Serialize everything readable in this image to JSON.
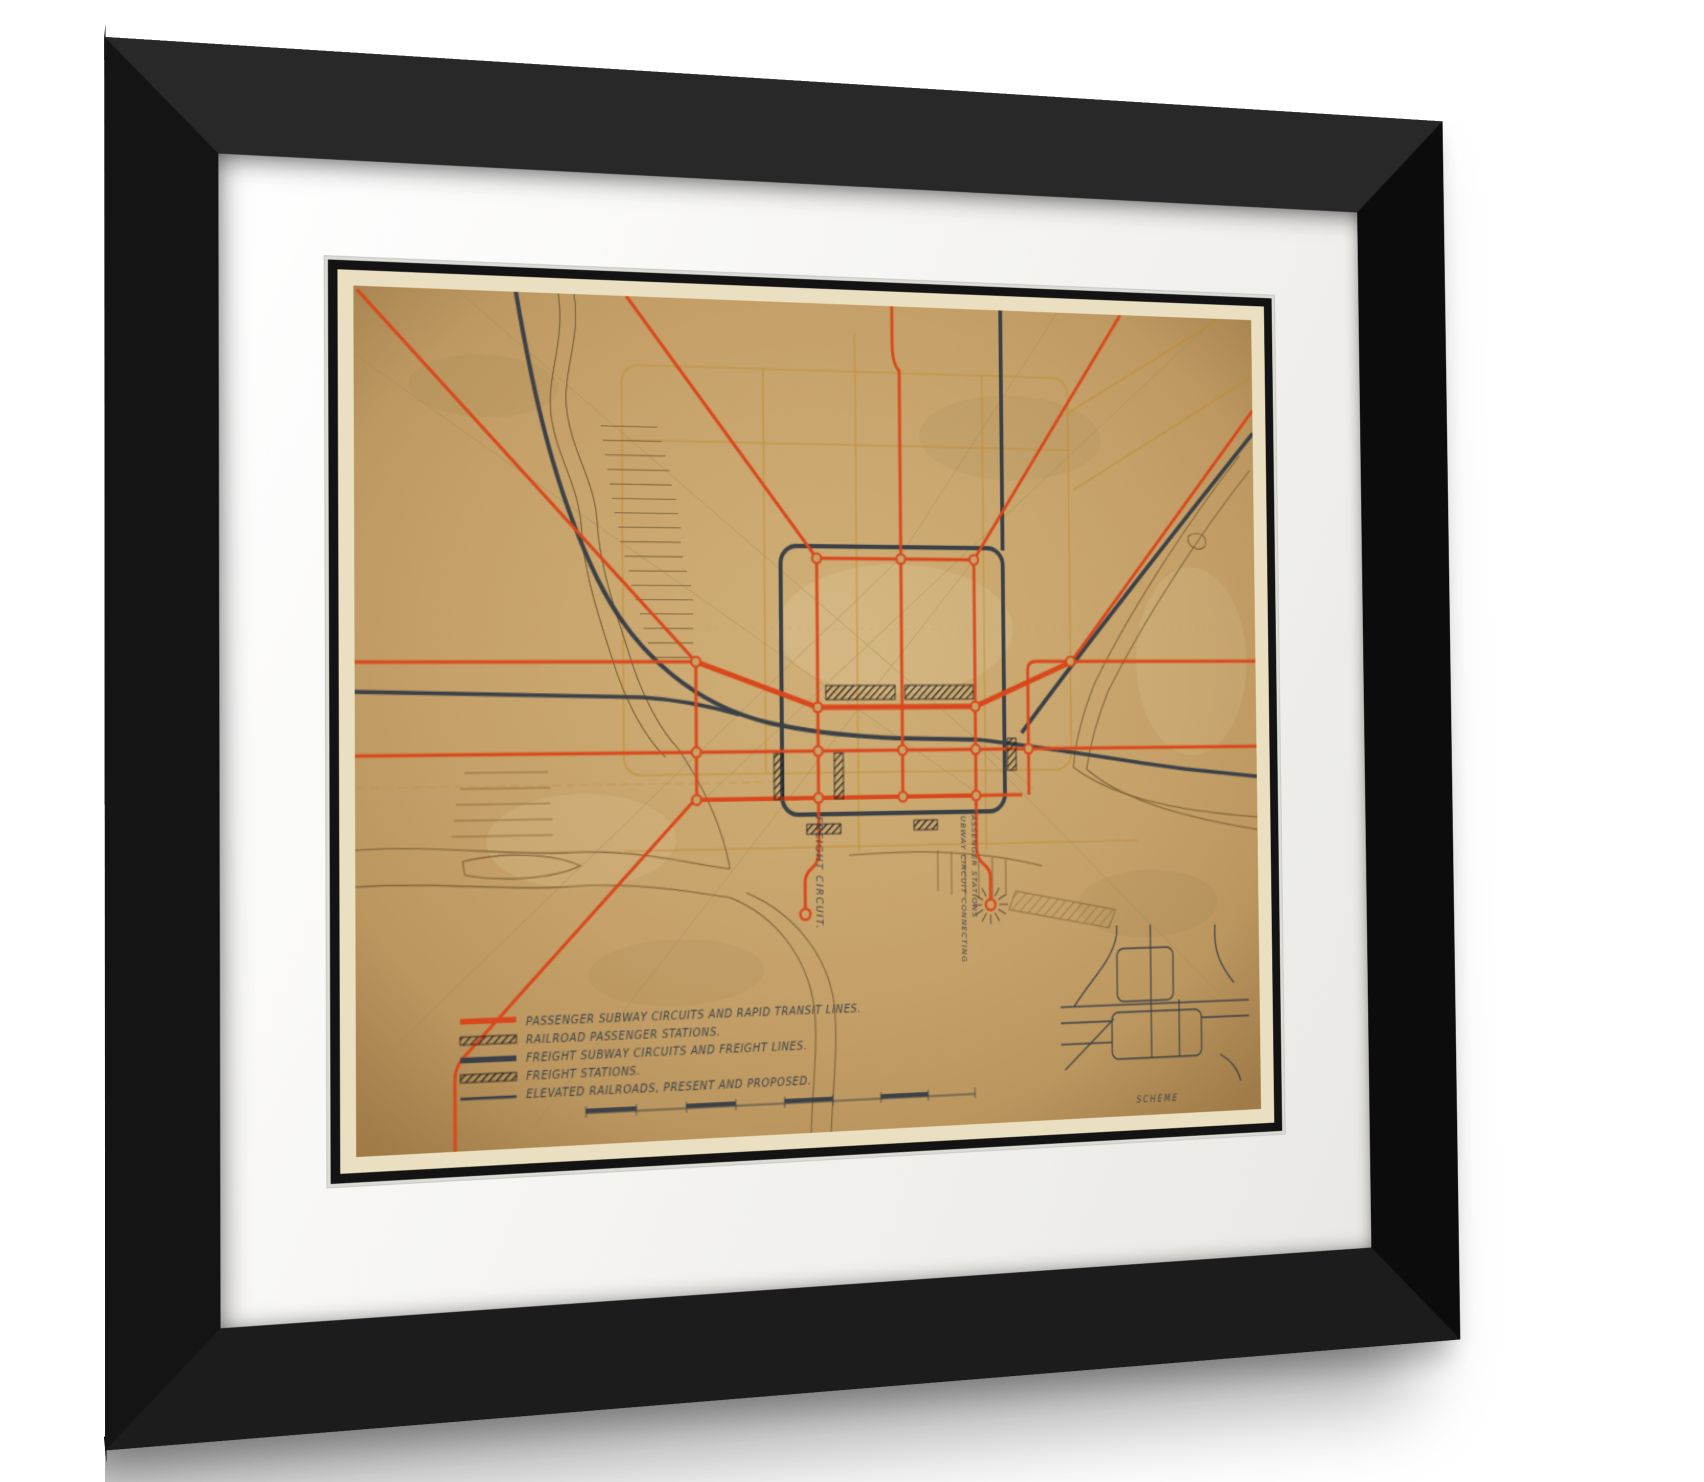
{
  "artwork": {
    "type": "framed transit plan map",
    "legend": {
      "items": [
        {
          "swatch": "passenger-line-swatch",
          "label": "PASSENGER SUBWAY CIRCUITS AND RAPID TRANSIT LINES."
        },
        {
          "swatch": "railroad-passenger-stations-swatch",
          "label": "RAILROAD PASSENGER STATIONS."
        },
        {
          "swatch": "freight-line-swatch",
          "label": "FREIGHT SUBWAY CIRCUITS AND FREIGHT LINES."
        },
        {
          "swatch": "freight-stations-swatch",
          "label": "FREIGHT STATIONS."
        },
        {
          "swatch": "elevated-railroads-swatch",
          "label": "ELEVATED RAILROADS, PRESENT AND PROPOSED."
        }
      ]
    },
    "labels": {
      "freight_circuit": "FREIGHT CIRCUIT.",
      "subway_circuit_line1": "SUBWAY CIRCUIT CONNECTING",
      "subway_circuit_line2": "PASSENGER STATIONS",
      "inset_caption": "SCHEME"
    },
    "colors": {
      "passenger_lines": "#d9481c",
      "freight_lines": "#3c4147",
      "paper": "#c7a36b",
      "street_grid": "#bf8c2e",
      "shoreline": "#7d6036",
      "frame": "#111111",
      "mat": "#f7f6f3"
    }
  }
}
